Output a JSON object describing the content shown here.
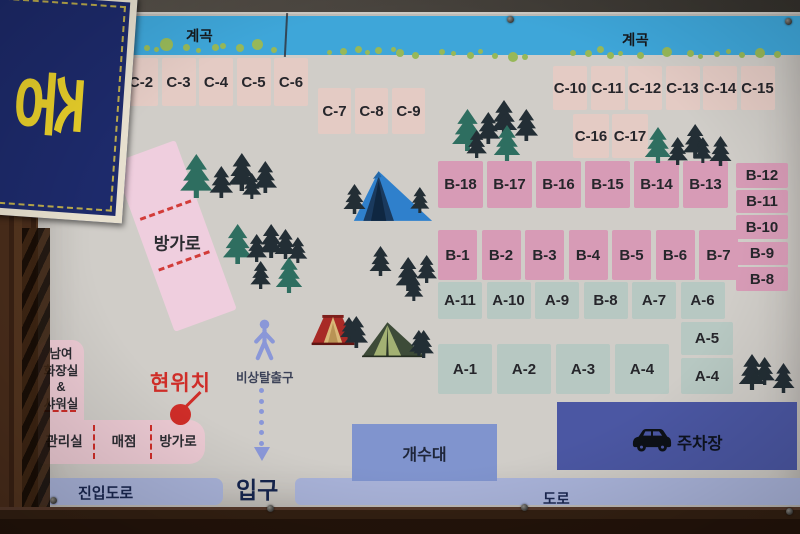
{
  "sign": {
    "corner_text": "중"
  },
  "stream": {
    "label_left": "계곡",
    "label_right": "계곡"
  },
  "sites": {
    "c_top": [
      "C-0",
      "C-1",
      "C-2",
      "C-3",
      "C-4",
      "C-5",
      "C-6"
    ],
    "c_mid": [
      "C-7",
      "C-8",
      "C-9"
    ],
    "c_right": [
      "C-10",
      "C-11",
      "C-12",
      "C-13",
      "C-14",
      "C-15"
    ],
    "c_lower": [
      "C-16",
      "C-17"
    ],
    "b_top": [
      "B-18",
      "B-17",
      "B-16",
      "B-15",
      "B-14",
      "B-13"
    ],
    "b_right": [
      "B-12",
      "B-11",
      "B-10",
      "B-9",
      "B-8"
    ],
    "b_mid": [
      "B-1",
      "B-2",
      "B-3",
      "B-4",
      "B-5",
      "B-6",
      "B-7"
    ],
    "a_top": [
      "A-11",
      "A-10",
      "A-9",
      "B-8",
      "A-7",
      "A-6"
    ],
    "a_right": [
      "A-5",
      "A-4"
    ],
    "a_bottom": [
      "A-1",
      "A-2",
      "A-3",
      "A-4"
    ]
  },
  "bungalow_zone": {
    "label": "방가로"
  },
  "restroom": {
    "line1": "남여",
    "line2": "화장실",
    "line3": "&",
    "line4": "샤워실"
  },
  "building_row": {
    "office": "관리실",
    "store": "매점",
    "bungalow": "방가로"
  },
  "markers": {
    "current_location": "현위치",
    "emergency_exit": "비상탈출구"
  },
  "roads": {
    "entrance": "입구",
    "access_road": "진입도로",
    "road": "도로"
  },
  "facilities": {
    "sink": "개수대",
    "parking": "주차장"
  },
  "palette": {
    "stream": "#3ea6d9",
    "dot_green": "#97b858",
    "site_c": "#e4cbc4",
    "site_c0": "#dcc29c",
    "site_b": "#d79bb6",
    "site_a": "#b7c8c2",
    "building_pink": "#eccad3",
    "bungalow_pink": "#efcede",
    "road_band": "#a9b3d9",
    "sink_box": "#8094ce",
    "parking_box": "#4b57a3",
    "tree_teal": "#2e6e60",
    "tree_dark": "#232e35",
    "accent_red": "#cf2d28",
    "person_blue": "#8a97d8",
    "sign_navy": "#1d2a6b",
    "sign_yellow": "#e8cf2a",
    "text_navy": "#1a2750"
  }
}
